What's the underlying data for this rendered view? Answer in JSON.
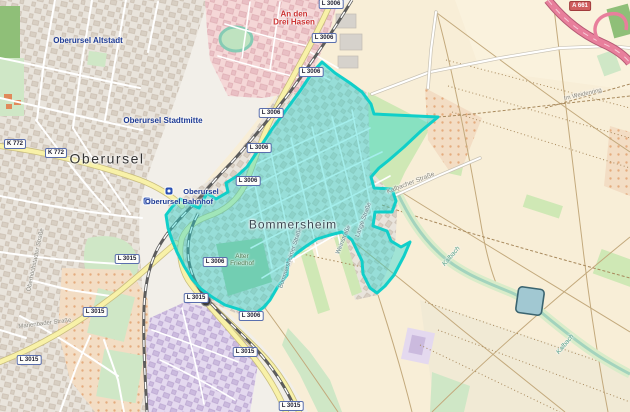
{
  "map_title": "Oberursel (Taunus) — Bommersheim highlighted district",
  "theme": {
    "base": "#f2efe9",
    "farmland": "#f8eed7",
    "farmland2": "#efe9d5",
    "town": "#e9e4dc",
    "buildingFill": "#d8cfc3",
    "buildingStroke": "#c6baac",
    "industrial": "#f5d7d7",
    "industrialBuilding": "#e9bfc4",
    "forest": "#8fbf78",
    "meadow": "#cfe7c6",
    "scrubGreen": "#cfe8b5",
    "cemetery": "#aac99b",
    "orchardBase": "#f3ddc4",
    "orchardDot": "#e0a06d",
    "retailPurple": "#e4d9ef",
    "retailBuilding": "#cbbade",
    "roadYellow": "#f8f1a8",
    "roadCasing": "#c9bd7f",
    "roadWhite": "#ffffff",
    "roadWhiteCasing": "#c8c2b4",
    "motorway": "#e87f9c",
    "motorwayCasing": "#b65a74",
    "railway": "#5c5c5c",
    "waterFill": "#a1c8d2",
    "stream": "#a3d3bd",
    "fieldLine": "#c3a97c",
    "trackDash": "#a8895c",
    "highlightFill": "#26d6d2",
    "highlightStroke": "#10cfc9",
    "cityLabel": "#1d3a94",
    "townLabel": "#333333",
    "redLabel": "#cc3333",
    "greenLabel": "#4e7a50"
  },
  "labels": {
    "altstadt": "Oberursel Altstadt",
    "stadtmitte": "Oberursel Stadtmitte",
    "town": "Oberursel",
    "station": "Oberursel",
    "bahnhof": "Oberursel Bahnhof",
    "bommersheim": "Bommersheim",
    "drei_hasen_1": "An den",
    "drei_hasen_2": "Drei Hasen",
    "friedhof_1": "Alter",
    "friedhof_2": "Friedhof",
    "kalbacher": "Kalbacher Straße",
    "weidenring": "Im Weidenring",
    "kalbach": "Kalbach",
    "bommersheimer": "Bommersheimer Straße",
    "lange": "Lange Straße",
    "wein": "Weinstraße",
    "oberhoechstadter": "Oberhöchstadter Straße",
    "marienbader": "Marienbader Straße"
  },
  "shields": {
    "l3006": "L 3006",
    "l3015": "L 3015",
    "k772": "K 772",
    "a661": "A 661"
  }
}
